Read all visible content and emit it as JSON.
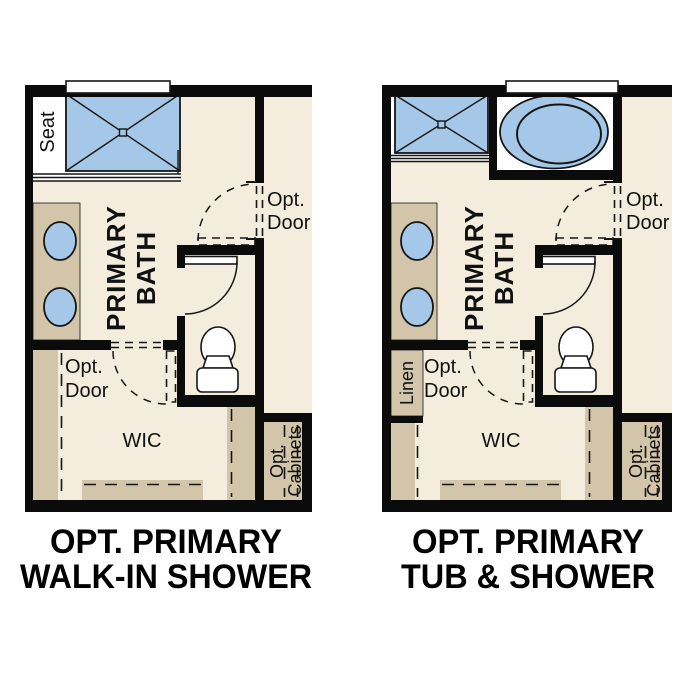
{
  "colors": {
    "wall": "#0b0b0b",
    "floor": "#f4ecdc",
    "cabinet": "#d2c5aa",
    "fixture": "#a6c8e8",
    "line": "#161616",
    "label": "#111111"
  },
  "plans": [
    {
      "name": "Optional Primary Walk-In Shower plan",
      "caption_line1": "OPT. PRIMARY",
      "caption_line2": "WALK-IN SHOWER",
      "labels": {
        "seat": "Seat",
        "room_line1": "PRIMARY",
        "room_line2": "BATH",
        "upper_door_line1": "Opt.",
        "upper_door_line2": "Door",
        "lower_door_line1": "Opt.",
        "lower_door_line2": "Door",
        "wic": "WIC",
        "cabinets_line1": "Opt.",
        "cabinets_line2": "Cabinets"
      }
    },
    {
      "name": "Optional Primary Tub & Shower plan",
      "caption_line1": "OPT. PRIMARY",
      "caption_line2": "TUB & SHOWER",
      "labels": {
        "room_line1": "PRIMARY",
        "room_line2": "BATH",
        "upper_door_line1": "Opt.",
        "upper_door_line2": "Door",
        "lower_door_line1": "Opt.",
        "lower_door_line2": "Door",
        "wic": "WIC",
        "linen": "Linen",
        "cabinets_line1": "Opt.",
        "cabinets_line2": "Cabinets"
      }
    }
  ]
}
